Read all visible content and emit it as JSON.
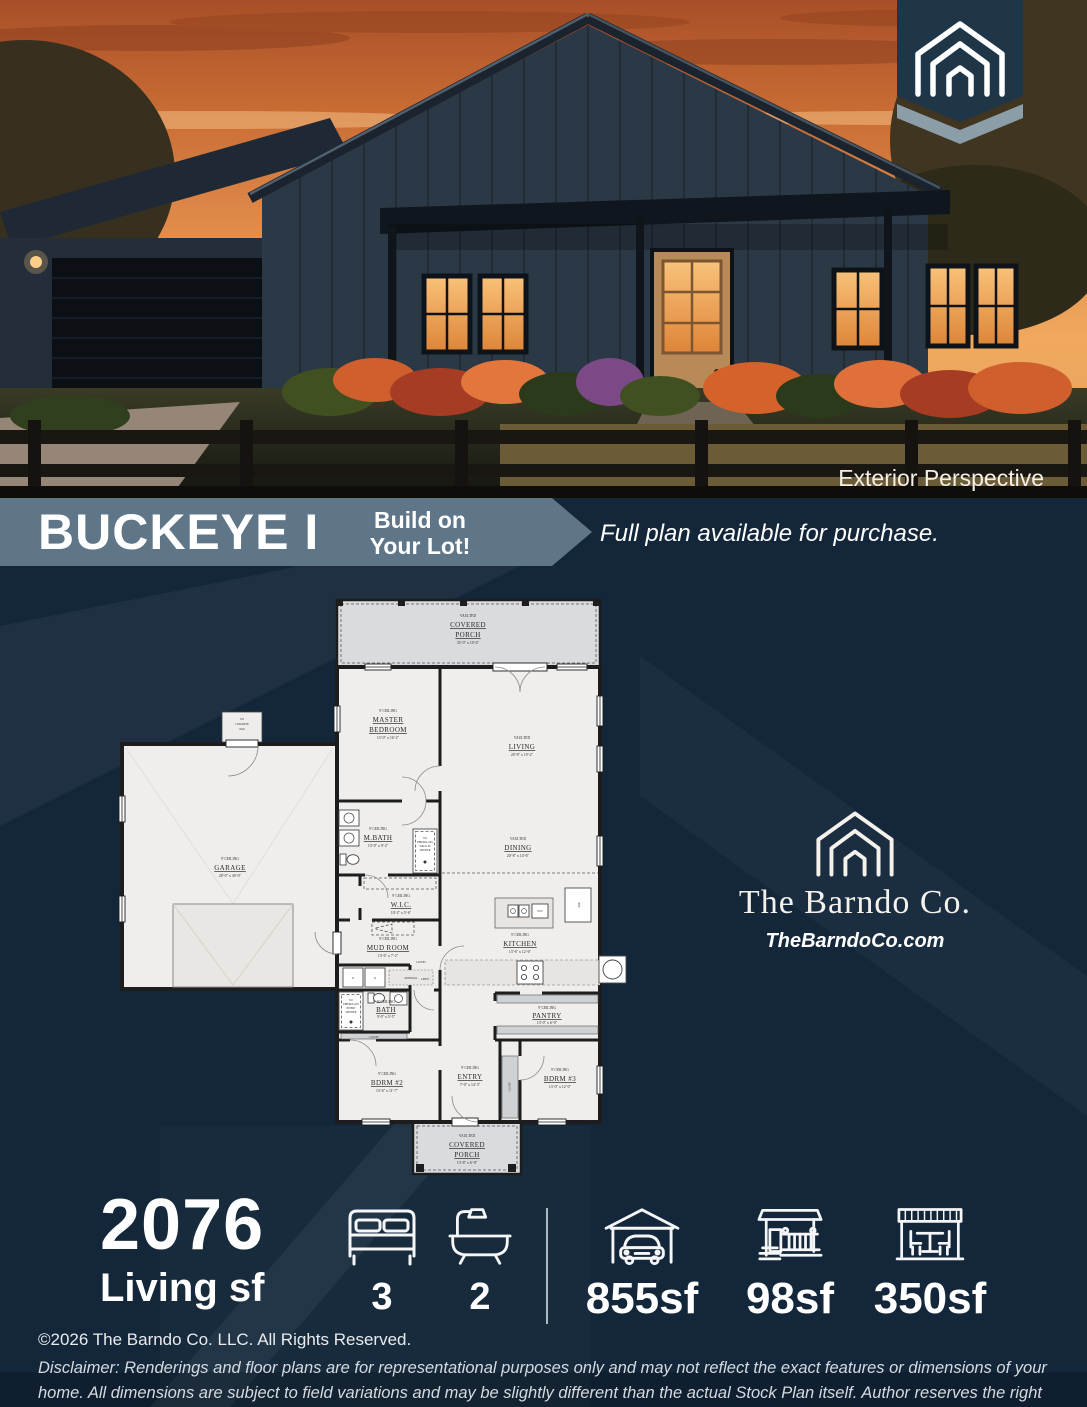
{
  "photo": {
    "caption": "Exterior Perspective"
  },
  "banner": {
    "title": "BUCKEYE I",
    "callout_line1": "Build on",
    "callout_line2": "Your Lot!",
    "note": "Full plan available for purchase."
  },
  "brand": {
    "name": "The Barndo Co.",
    "website": "TheBarndoCo.com"
  },
  "floorplan": {
    "rooms": [
      {
        "note": "VAULTED",
        "name": "COVERED",
        "name2": "PORCH",
        "dims": "35'-0\" x 10'-6\""
      },
      {
        "note": "9' CEILING",
        "name": "MASTER",
        "name2": "BEDROOM",
        "dims": "13'-0\" x 16'-2\""
      },
      {
        "note": "VAULTED",
        "name": "LIVING",
        "dims": "20'-8\" x 19'-2\""
      },
      {
        "note": "9' CEILING",
        "name": "GARAGE",
        "dims": "28'-0\" x 30'-0\""
      },
      {
        "note": "9' CEILING",
        "name": "M.BATH",
        "dims": "13'-0\" x 9'-2\""
      },
      {
        "note": "VAULTED",
        "name": "DINING",
        "dims": "20'-8\" x 14'-6\""
      },
      {
        "note": "9' CEILING",
        "name": "W.I.C.",
        "dims": "10'-2\" x 5'-6\""
      },
      {
        "note": "9' CEILING",
        "name": "MUD ROOM",
        "dims": "13'-6\" x 7'-2\""
      },
      {
        "note": "9' CEILING",
        "name": "KITCHEN",
        "dims": "13'-6\" x 12'-6\""
      },
      {
        "note": "9' CEILING",
        "name": "BATH",
        "dims": "9'-0\" x 5'-5\""
      },
      {
        "note": "9' CEILING",
        "name": "PANTRY",
        "dims": "13'-0\" x 6'-0\""
      },
      {
        "note": "9' CEILING",
        "name": "BDRM #2",
        "dims": "13'-6\" x 11'-7\""
      },
      {
        "note": "9' CEILING",
        "name": "ENTRY",
        "dims": "7'-0\" x 14'-3\""
      },
      {
        "note": "9' CEILING",
        "name": "BDRM #3",
        "dims": "13'-0\" x 12'-0\""
      },
      {
        "note": "VAULTED",
        "name": "COVERED",
        "name2": "PORCH",
        "dims": "13'-8\" x 6'-8\""
      }
    ],
    "labels": {
      "pad1": "3x3",
      "pad2": "CONCRETE",
      "pad3": "PAD",
      "sw1": "3x5",
      "sw2": "FIBERGLASS",
      "sw3": "WALK-IN",
      "sw4": "SHOWER",
      "si1": "3x5",
      "si2": "FIBERGLASS",
      "si3": "INSERT",
      "si4": "SHOWER",
      "pet_wash": "PET WASH",
      "optional": "OPTIONAL",
      "closet": "CLOSET",
      "linen": "LINEN",
      "washer": "W",
      "dryer": "D",
      "dishwasher": "D/W",
      "ref": "REF"
    }
  },
  "stats": {
    "living_value": "2076",
    "living_label": "Living sf",
    "beds": "3",
    "baths": "2",
    "garage_sf": "855sf",
    "porch_sf": "98sf",
    "patio_sf": "350sf"
  },
  "footer": {
    "copyright": "©2026 The Barndo Co. LLC. All Rights Reserved.",
    "disclaimer": "Disclaimer: Renderings and floor plans are for representational purposes only and may not reflect the exact features or dimensions of your home. All dimensions are subject to field variations and may be slightly different than the actual Stock Plan itself. Author reserves the right to alter, update and improve Stock Plans at their discretion."
  },
  "colors": {
    "background": "#14273a",
    "banner": "#5e7688",
    "plan_floor": "#f0eeec",
    "porch": "#d9dbde",
    "wall": "#1d1d1d",
    "sunset": "#e08a4a"
  }
}
